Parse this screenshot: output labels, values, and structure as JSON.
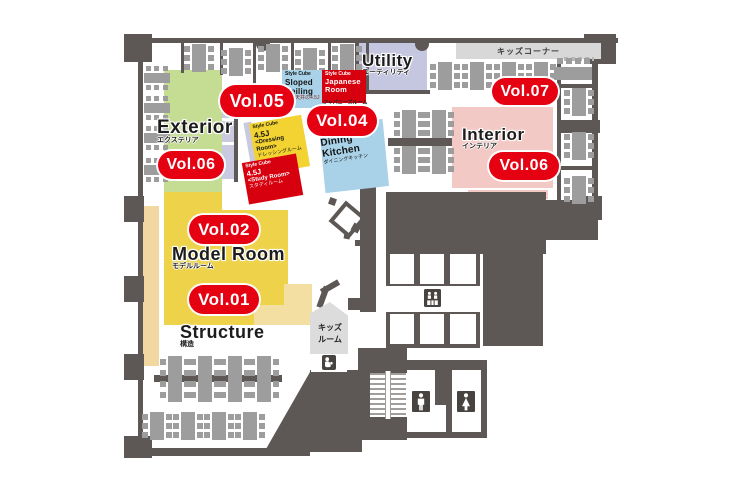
{
  "badges": {
    "vol01": "Vol.01",
    "vol02": "Vol.02",
    "vol04": "Vol.04",
    "vol05": "Vol.05",
    "vol06_left": "Vol.06",
    "vol06_right": "Vol.06",
    "vol07": "Vol.07"
  },
  "zones": {
    "exterior": {
      "title": "Exterior",
      "subtitle": "エクステリア"
    },
    "model_room": {
      "title": "Model Room",
      "subtitle": "モデルルーム"
    },
    "structure": {
      "title": "Structure",
      "subtitle": "構造"
    },
    "utility": {
      "title": "Utility",
      "subtitle": "ユーティリティ"
    },
    "interior": {
      "title": "Interior",
      "subtitle": "インテリア"
    },
    "kids_corner": {
      "label": "キッズコーナー"
    },
    "kids_room": {
      "line1": "キッズ",
      "line2": "ルーム"
    }
  },
  "style_cubes": {
    "sloped_ceiling": {
      "header": "Style Cube",
      "line1": "Sloped",
      "line2": "Ceiling",
      "subtitle": "勾配天井の4.5J模型"
    },
    "japanese_room": {
      "header": "Style Cube",
      "line1": "Japanese",
      "line2": "Room",
      "subtitle": "ジャパニーズルーム"
    },
    "dressing_room": {
      "header": "Style Cube",
      "size": "4.5J",
      "name": "<Dressing Room>",
      "subtitle": "ドレッシングルーム"
    },
    "study_room": {
      "header": "Style Cube",
      "size": "4.5J",
      "name": "<Study Room>",
      "subtitle": "スタディルーム"
    },
    "dining_kitchen": {
      "header": "Style Cube",
      "line1": "Dining",
      "line2": "Kitchen",
      "subtitle": "ダイニングキッチン"
    }
  },
  "icons": {
    "elevator": "elevator-icon",
    "nursing_room": "nursing-room-icon",
    "mens_restroom": "mens-restroom-icon",
    "womens_restroom": "womens-restroom-icon"
  },
  "colors": {
    "badge_red": "#e50012",
    "cube_red": "#d7000f",
    "cube_blue": "#a9d2e8",
    "cube_yellow": "#f2d331",
    "exterior_green": "#c5dc93",
    "model_room_yellow": "#eed34a",
    "structure_cream": "#f4dfa2",
    "interior_pink": "#f3c9c5",
    "utility_lavender": "#c5c6e0",
    "wall_gray": "#5d5856",
    "desk_gray": "#9d9d9d"
  }
}
